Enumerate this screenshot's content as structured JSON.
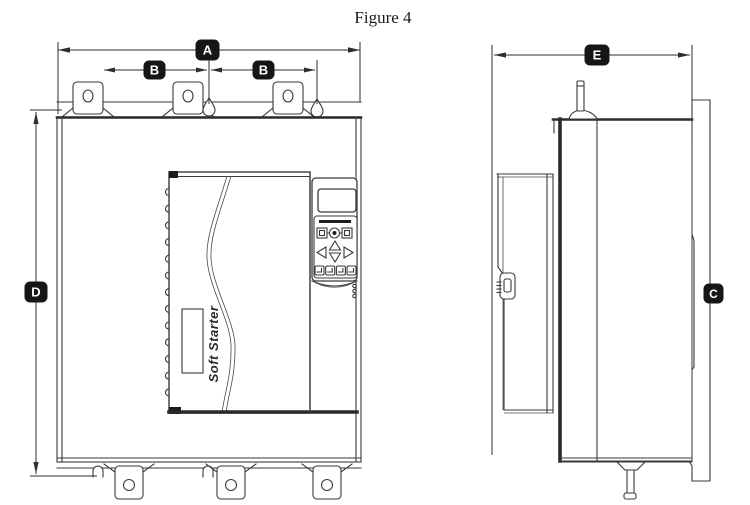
{
  "figure_title": "Figure 4",
  "front_view": {
    "brand_label": "Soft Starter",
    "dim_overall_width_label": "A",
    "dim_hole_spacing_left_label": "B",
    "dim_hole_spacing_right_label": "B",
    "dim_overall_height_label": "D"
  },
  "side_view": {
    "dim_overall_depth_label": "E",
    "dim_mounting_plate_label": "C"
  },
  "colors": {
    "background": "#ffffff",
    "line": "#3a3a3a",
    "thick_edge": "#2b2b2b",
    "dim_label_bg": "#161616",
    "dim_label_fg": "#ffffff"
  }
}
